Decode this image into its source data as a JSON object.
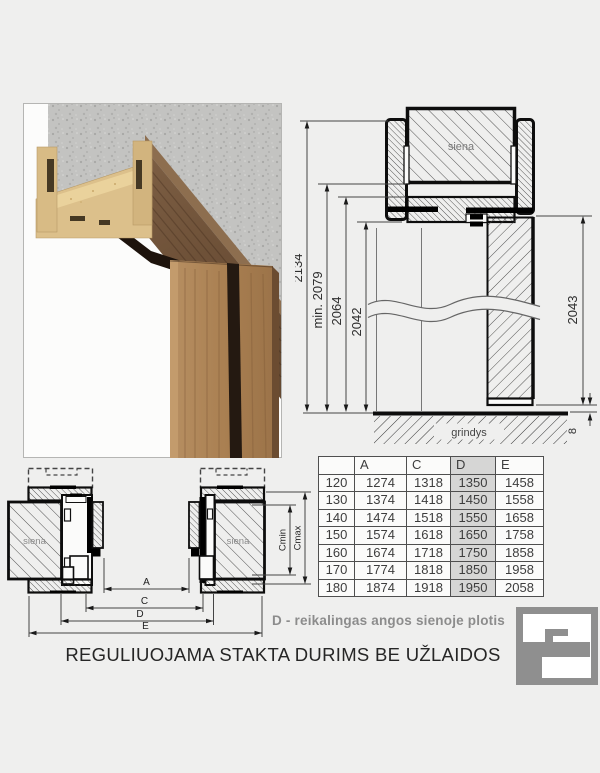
{
  "vertical_section": {
    "wall_label": "siena",
    "floor_label": "grindys",
    "dims": {
      "total_height": "2134",
      "min_height": "min. 2079",
      "frame_height": "2064",
      "opening_height": "2042",
      "door_height": "2043",
      "floor_gap": "8"
    }
  },
  "horizontal_section": {
    "wall_label_left": "siena",
    "wall_label_right": "siena",
    "dims": {
      "a": "A",
      "c": "C",
      "d": "D",
      "e": "E",
      "c_min": "Cmin",
      "c_max": "Cmax"
    }
  },
  "table": {
    "headers": [
      "",
      "A",
      "C",
      "D",
      "E"
    ],
    "rows": [
      [
        "120",
        "1274",
        "1318",
        "1350",
        "1458"
      ],
      [
        "130",
        "1374",
        "1418",
        "1450",
        "1558"
      ],
      [
        "140",
        "1474",
        "1518",
        "1550",
        "1658"
      ],
      [
        "150",
        "1574",
        "1618",
        "1650",
        "1758"
      ],
      [
        "160",
        "1674",
        "1718",
        "1750",
        "1858"
      ],
      [
        "170",
        "1774",
        "1818",
        "1850",
        "1958"
      ],
      [
        "180",
        "1874",
        "1918",
        "1950",
        "2058"
      ]
    ],
    "highlighted_column_index": 3,
    "highlight_color": "#d6d6d5"
  },
  "note": {
    "text": "D - reikalingas angos sienoje plotis"
  },
  "title": {
    "text": "REGULIUOJAMA STAKTA DURIMS BE UŽLAIDOS"
  },
  "colors": {
    "background": "#efefee",
    "logo_gray": "#8f8f8f",
    "line_black": "#0d0d0d"
  }
}
